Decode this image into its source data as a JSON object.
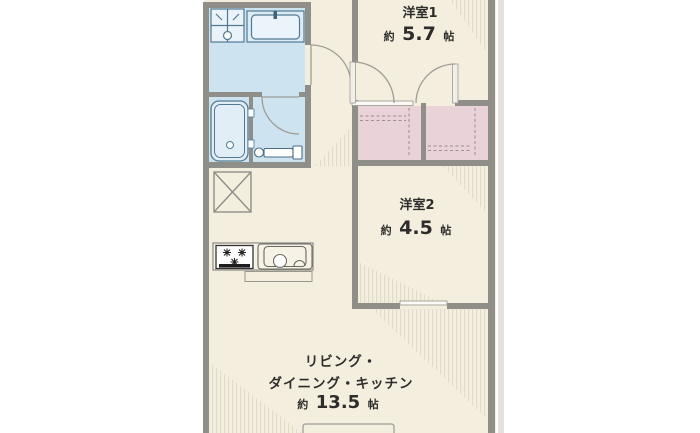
{
  "floor_plan": {
    "rooms": {
      "western_room_1": {
        "name": "洋室1",
        "area_prefix": "約",
        "area_value": "5.7",
        "area_unit": "帖"
      },
      "western_room_2": {
        "name": "洋室2",
        "area_prefix": "約",
        "area_value": "4.5",
        "area_unit": "帖"
      },
      "ldk": {
        "name_line_1": "リビング・",
        "name_line_2": "ダイニング・キッチン",
        "area_prefix": "約",
        "area_value": "13.5",
        "area_unit": "帖"
      }
    },
    "colors": {
      "background": "#ffffff",
      "floor": "#f3eede",
      "wet_area": "#cde3ef",
      "closet": "#e9d2d8",
      "wall": "#8f8e89",
      "outline": "#a09d96",
      "fixture_stroke": "#527a93",
      "fixture_fill": "#e9f3f9",
      "text": "#2e2d2b",
      "outer_strip": "#e3e1da"
    }
  }
}
